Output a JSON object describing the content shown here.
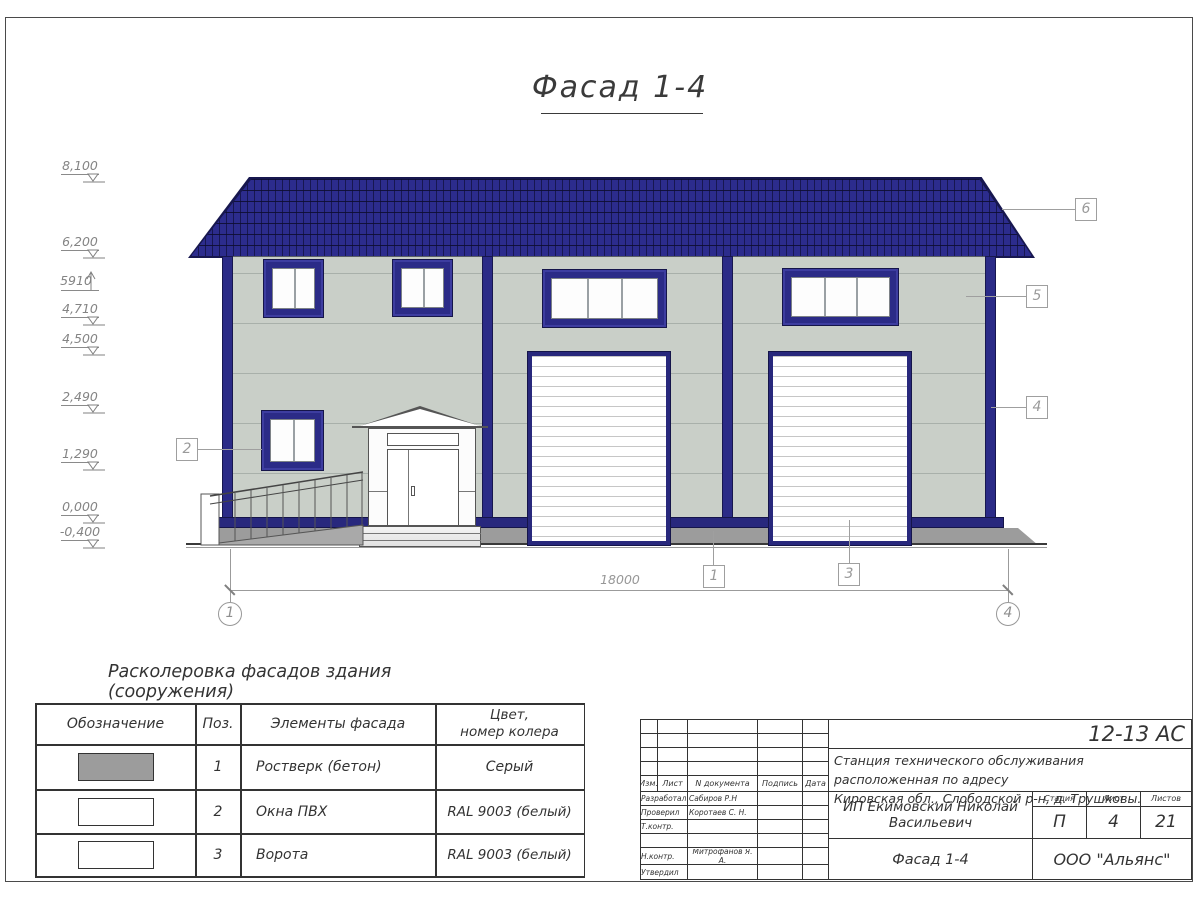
{
  "sheet": {
    "title": "Фасад 1-4"
  },
  "elevations": [
    {
      "value": "8,100"
    },
    {
      "value": "6,200"
    },
    {
      "value": "5910"
    },
    {
      "value": "4,710"
    },
    {
      "value": "4,500"
    },
    {
      "value": "2,490"
    },
    {
      "value": "1,290"
    },
    {
      "value": "0,000"
    },
    {
      "value": "-0,400"
    }
  ],
  "dimension": {
    "value": "18000"
  },
  "axes": {
    "left": "1",
    "right": "4"
  },
  "callouts": {
    "c1": "1",
    "c2": "2",
    "c3": "3",
    "c4": "4",
    "c5": "5",
    "c6": "6"
  },
  "colors": {
    "roof": "#2c2c8d",
    "frames": "#2b2b87",
    "wall": "#c9cfc8",
    "plinth": "#9c9c9c"
  },
  "legend": {
    "title": "Расколеровка фасадов здания (сооружения)",
    "h_designation": "Обозначение",
    "h_pos": "Поз.",
    "h_element": "Элементы фасада",
    "h_color1": "Цвет,",
    "h_color2": "номер колера",
    "rows": [
      {
        "swatch": "#9c9c9c",
        "pos": "1",
        "element": "Ростверк (бетон)",
        "color": "Серый"
      },
      {
        "swatch": "#ffffff",
        "pos": "2",
        "element": "Окна ПВХ",
        "color": "RAL 9003 (белый)"
      },
      {
        "swatch": "#ffffff",
        "pos": "3",
        "element": "Ворота",
        "color": "RAL 9003 (белый)"
      }
    ]
  },
  "titleblock": {
    "doc_number": "12-13 АС",
    "project_line1": "Станция технического обслуживания расположенная по адресу",
    "project_line2": "Кировская обл., Слободской р-н, д. Трушковы.",
    "client": "ИП Екимовский Николай Васильевич",
    "drawing_title": "Фасад 1-4",
    "organization": "ООО \"Альянс\"",
    "stage_label": "Стадия",
    "sheet_label": "Лист",
    "sheets_label": "Листов",
    "stage": "П",
    "sheet": "4",
    "sheets": "21",
    "rev_headers": [
      "Изм.",
      "Лист",
      "N документа",
      "Подпись",
      "Дата"
    ],
    "roles": [
      {
        "label": "Разработал",
        "name": "Сабиров Р.Н"
      },
      {
        "label": "Проверил",
        "name": "Коротаев С. Н."
      },
      {
        "label": "Т.контр.",
        "name": ""
      },
      {
        "label": "",
        "name": ""
      },
      {
        "label": "Н.контр.",
        "name": "Митрофанов Я. А."
      },
      {
        "label": "Утвердил",
        "name": ""
      }
    ]
  }
}
